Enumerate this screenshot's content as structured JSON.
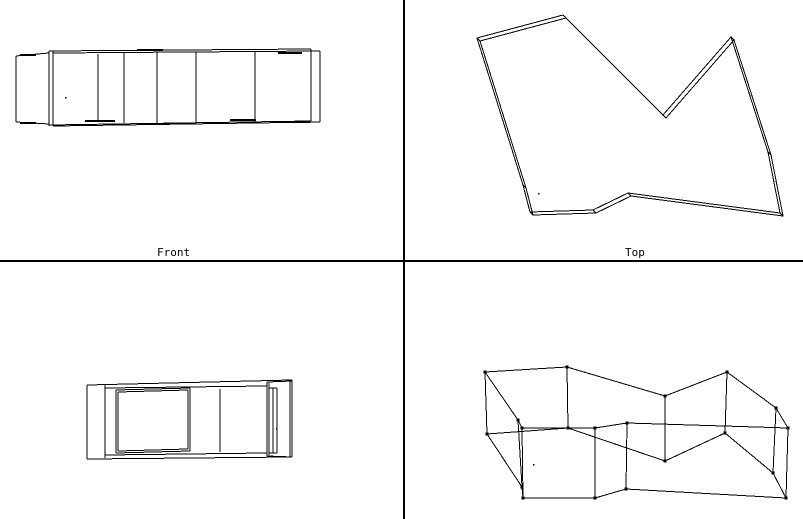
{
  "colors": {
    "background": "#ffffff",
    "line": "#000000",
    "vertex": "#000000"
  },
  "viewports": {
    "front": {
      "label": "Front"
    },
    "top": {
      "label": "Top"
    },
    "side": {
      "label": ""
    },
    "perspective": {
      "label": ""
    }
  },
  "dividers": [
    [
      404,
      0,
      404,
      519
    ],
    [
      0,
      261,
      803,
      261
    ]
  ],
  "drawing": {
    "front": {
      "segments": [
        [
          16,
          56,
          16,
          122
        ],
        [
          16,
          56,
          49,
          53
        ],
        [
          16,
          122,
          49,
          124
        ],
        [
          49,
          51,
          49,
          126
        ],
        [
          53,
          51,
          53,
          126
        ],
        [
          49,
          51,
          311,
          49
        ],
        [
          53,
          53,
          320,
          51
        ],
        [
          49,
          125,
          311,
          121
        ],
        [
          53,
          126,
          320,
          122
        ],
        [
          311,
          49,
          311,
          121
        ],
        [
          320,
          51,
          320,
          122
        ],
        [
          98,
          54,
          98,
          122
        ],
        [
          124,
          52,
          124,
          123
        ],
        [
          157,
          52,
          157,
          123
        ],
        [
          196,
          52,
          196,
          123
        ],
        [
          255,
          52,
          255,
          122
        ]
      ],
      "accents": [
        [
          20,
          55,
          36,
          55
        ],
        [
          20,
          123,
          36,
          123
        ],
        [
          137,
          50,
          163,
          50
        ],
        [
          278,
          53,
          302,
          53
        ],
        [
          85,
          121,
          115,
          121
        ],
        [
          142,
          124,
          170,
          124
        ],
        [
          230,
          120,
          256,
          120
        ],
        [
          282,
          122,
          310,
          122
        ]
      ],
      "dot": [
        65,
        97
      ]
    },
    "top": {
      "outline": [
        [
          477,
          38
        ],
        [
          563,
          15
        ],
        [
          663,
          115
        ],
        [
          731,
          37
        ],
        [
          768,
          152
        ],
        [
          780,
          213
        ],
        [
          628,
          193
        ],
        [
          593,
          210
        ],
        [
          530,
          212
        ],
        [
          523,
          185
        ]
      ],
      "offset": [
        3,
        3
      ],
      "dot": [
        538,
        193
      ]
    },
    "side": {
      "segments": [
        [
          87,
          385,
          292,
          380
        ],
        [
          292,
          380,
          292,
          457
        ],
        [
          87,
          459,
          292,
          457
        ],
        [
          87,
          385,
          87,
          459
        ],
        [
          105,
          384,
          105,
          458
        ],
        [
          105,
          388,
          267,
          386
        ],
        [
          105,
          455,
          267,
          453
        ],
        [
          116,
          390,
          190,
          388
        ],
        [
          190,
          388,
          190,
          451
        ],
        [
          116,
          453,
          190,
          451
        ],
        [
          116,
          390,
          116,
          453
        ],
        [
          118,
          392,
          188,
          390
        ],
        [
          188,
          390,
          188,
          449
        ],
        [
          118,
          451,
          188,
          449
        ],
        [
          118,
          392,
          118,
          451
        ],
        [
          220,
          389,
          220,
          452
        ],
        [
          267,
          382,
          267,
          456
        ],
        [
          269,
          383,
          269,
          455
        ],
        [
          273,
          388,
          273,
          453
        ],
        [
          277,
          388,
          277,
          453
        ],
        [
          290,
          381,
          290,
          457
        ],
        [
          267,
          382,
          292,
          381
        ],
        [
          269,
          388,
          277,
          388
        ],
        [
          269,
          453,
          277,
          453
        ],
        [
          267,
          456,
          292,
          457
        ]
      ],
      "dot": [
        276,
        428
      ]
    },
    "perspective": {
      "top_ring": [
        [
          485,
          372
        ],
        [
          567,
          367
        ],
        [
          665,
          396
        ],
        [
          727,
          372
        ],
        [
          776,
          408
        ],
        [
          788,
          428
        ],
        [
          627,
          423
        ],
        [
          595,
          428
        ],
        [
          522,
          428
        ],
        [
          518,
          420
        ]
      ],
      "bottom_ring": [
        [
          487,
          434
        ],
        [
          568,
          428
        ],
        [
          665,
          461
        ],
        [
          725,
          433
        ],
        [
          773,
          473
        ],
        [
          786,
          498
        ],
        [
          626,
          489
        ],
        [
          595,
          498
        ],
        [
          523,
          498
        ],
        [
          522,
          487
        ]
      ],
      "vertex_size": 3,
      "dot": [
        533,
        464
      ]
    }
  }
}
